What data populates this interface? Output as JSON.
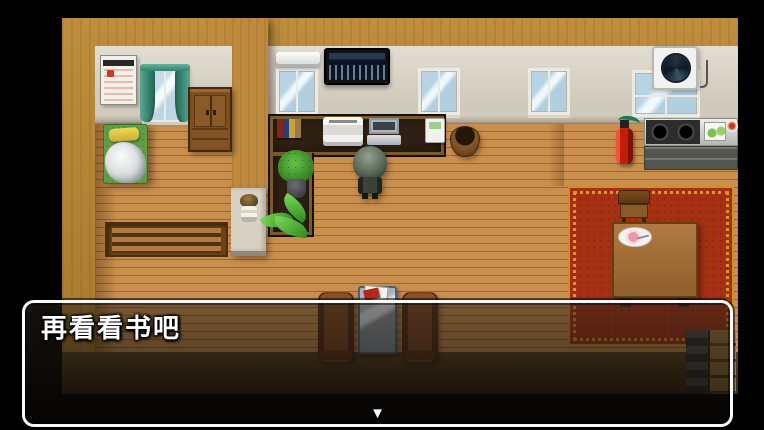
{
  "dialog": {
    "text": "再看看书吧",
    "continue_indicator": "▼"
  },
  "palette": {
    "letterbox": "#000000",
    "wood_frame": "#b5812e",
    "interior_wall": "#d9d2c4",
    "floor_wood": "#c08648",
    "carpet_red": "#a53014",
    "carpet_border_gold": "#cf8f28",
    "dialog_border": "#f8f8f8",
    "dialog_text": "#ffffff"
  },
  "scene": {
    "objects": [
      "calendar",
      "curtain-window",
      "wardrobe",
      "bed",
      "wooden-bench",
      "air-conditioner",
      "wall-tv",
      "window",
      "ventilation-fan",
      "office-desk",
      "books",
      "printer",
      "laptop",
      "telephone",
      "desk-plant",
      "floor-plant",
      "pillar-lamp",
      "planter-pot",
      "player-character",
      "fire-extinguisher",
      "stove",
      "cutting-board",
      "food-dish",
      "red-carpet",
      "dining-table",
      "dinner-plate",
      "chair",
      "sofa",
      "glass-table",
      "magazine"
    ]
  }
}
